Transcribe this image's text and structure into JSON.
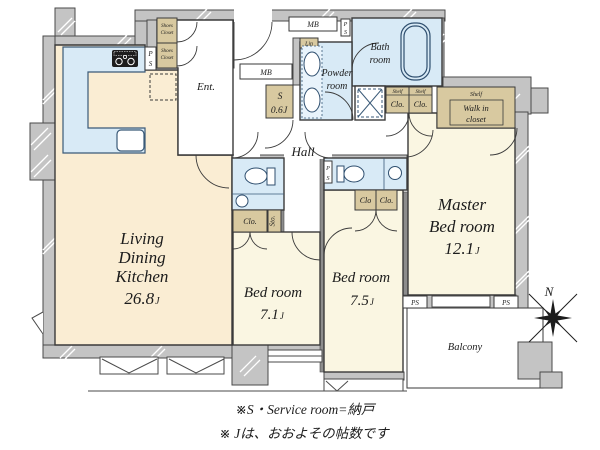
{
  "rooms": {
    "ldk": {
      "line1": "Living",
      "line2": "Dining",
      "line3": "Kitchen",
      "area": "26.8"
    },
    "bed1": {
      "name": "Bed room",
      "area": "7.1"
    },
    "bed2": {
      "name": "Bed room",
      "area": "7.5"
    },
    "master": {
      "line1": "Master",
      "line2": "Bed room",
      "area": "12.1"
    },
    "service": {
      "name": "S",
      "area": "0.6"
    },
    "bath": {
      "line1": "Bath",
      "line2": "room"
    },
    "powder": {
      "line1": "Powder",
      "line2": "room"
    },
    "ent": "Ent.",
    "hall": "Hall",
    "balcony": "Balcony"
  },
  "unit": "J",
  "labels": {
    "mb": "MB",
    "ps": "PS",
    "p": "P",
    "s": "S",
    "lin": "Lin",
    "sto": "Sto.",
    "clo": "Clo.",
    "clo_nodot": "Clo",
    "shelf": "Shelf",
    "walkin_line1": "Walk in",
    "walkin_line2": "closet",
    "shoes_line1": "Shoes",
    "shoes_line2": "Closet"
  },
  "compass": {
    "north": "N"
  },
  "notes": {
    "line1": "※S・Service room=納戸",
    "line2": "※ Jは、おおよその帖数です"
  },
  "palette": {
    "wall": "#c4c4c4",
    "ldk_floor": "#faedd3",
    "bedroom_floor": "#faf6e2",
    "water_floor": "#d8eaf6",
    "closet": "#d8c9a0"
  }
}
